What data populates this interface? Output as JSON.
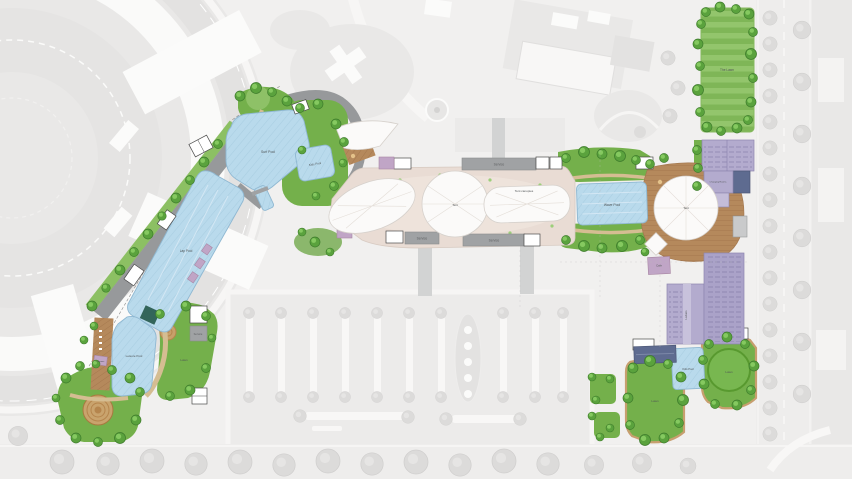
{
  "labels": {
    "service": "Service",
    "tent": "Tent",
    "tent_canopies": "Tent canopies",
    "surf_pool": "Surf Pool",
    "kids_pool": "Kids Pool",
    "lap_pool": "Lap Pool",
    "leisure_pool": "Leisure Pool",
    "wave_pool": "Wave Pool",
    "lawn": "Lawn",
    "the_lawn": "The Lawn",
    "cafe": "Cafe",
    "changing_rooms": "Changing Rooms",
    "lockers": "Lockers",
    "cabanas": "Cabanas"
  },
  "colors": {
    "background": "#f1f0ef",
    "context": "#e9e8e7",
    "pool": "#b9daec",
    "lawn": "#74b04b",
    "tree": "#5aa23d",
    "deck": "#b5895c",
    "plaza": "#e9dcd4",
    "canopy": "#fbfaf9",
    "promenade": "#97999b",
    "service": "#a0a2a4",
    "purple": "#b3abce",
    "navy": "#5e6b90"
  }
}
